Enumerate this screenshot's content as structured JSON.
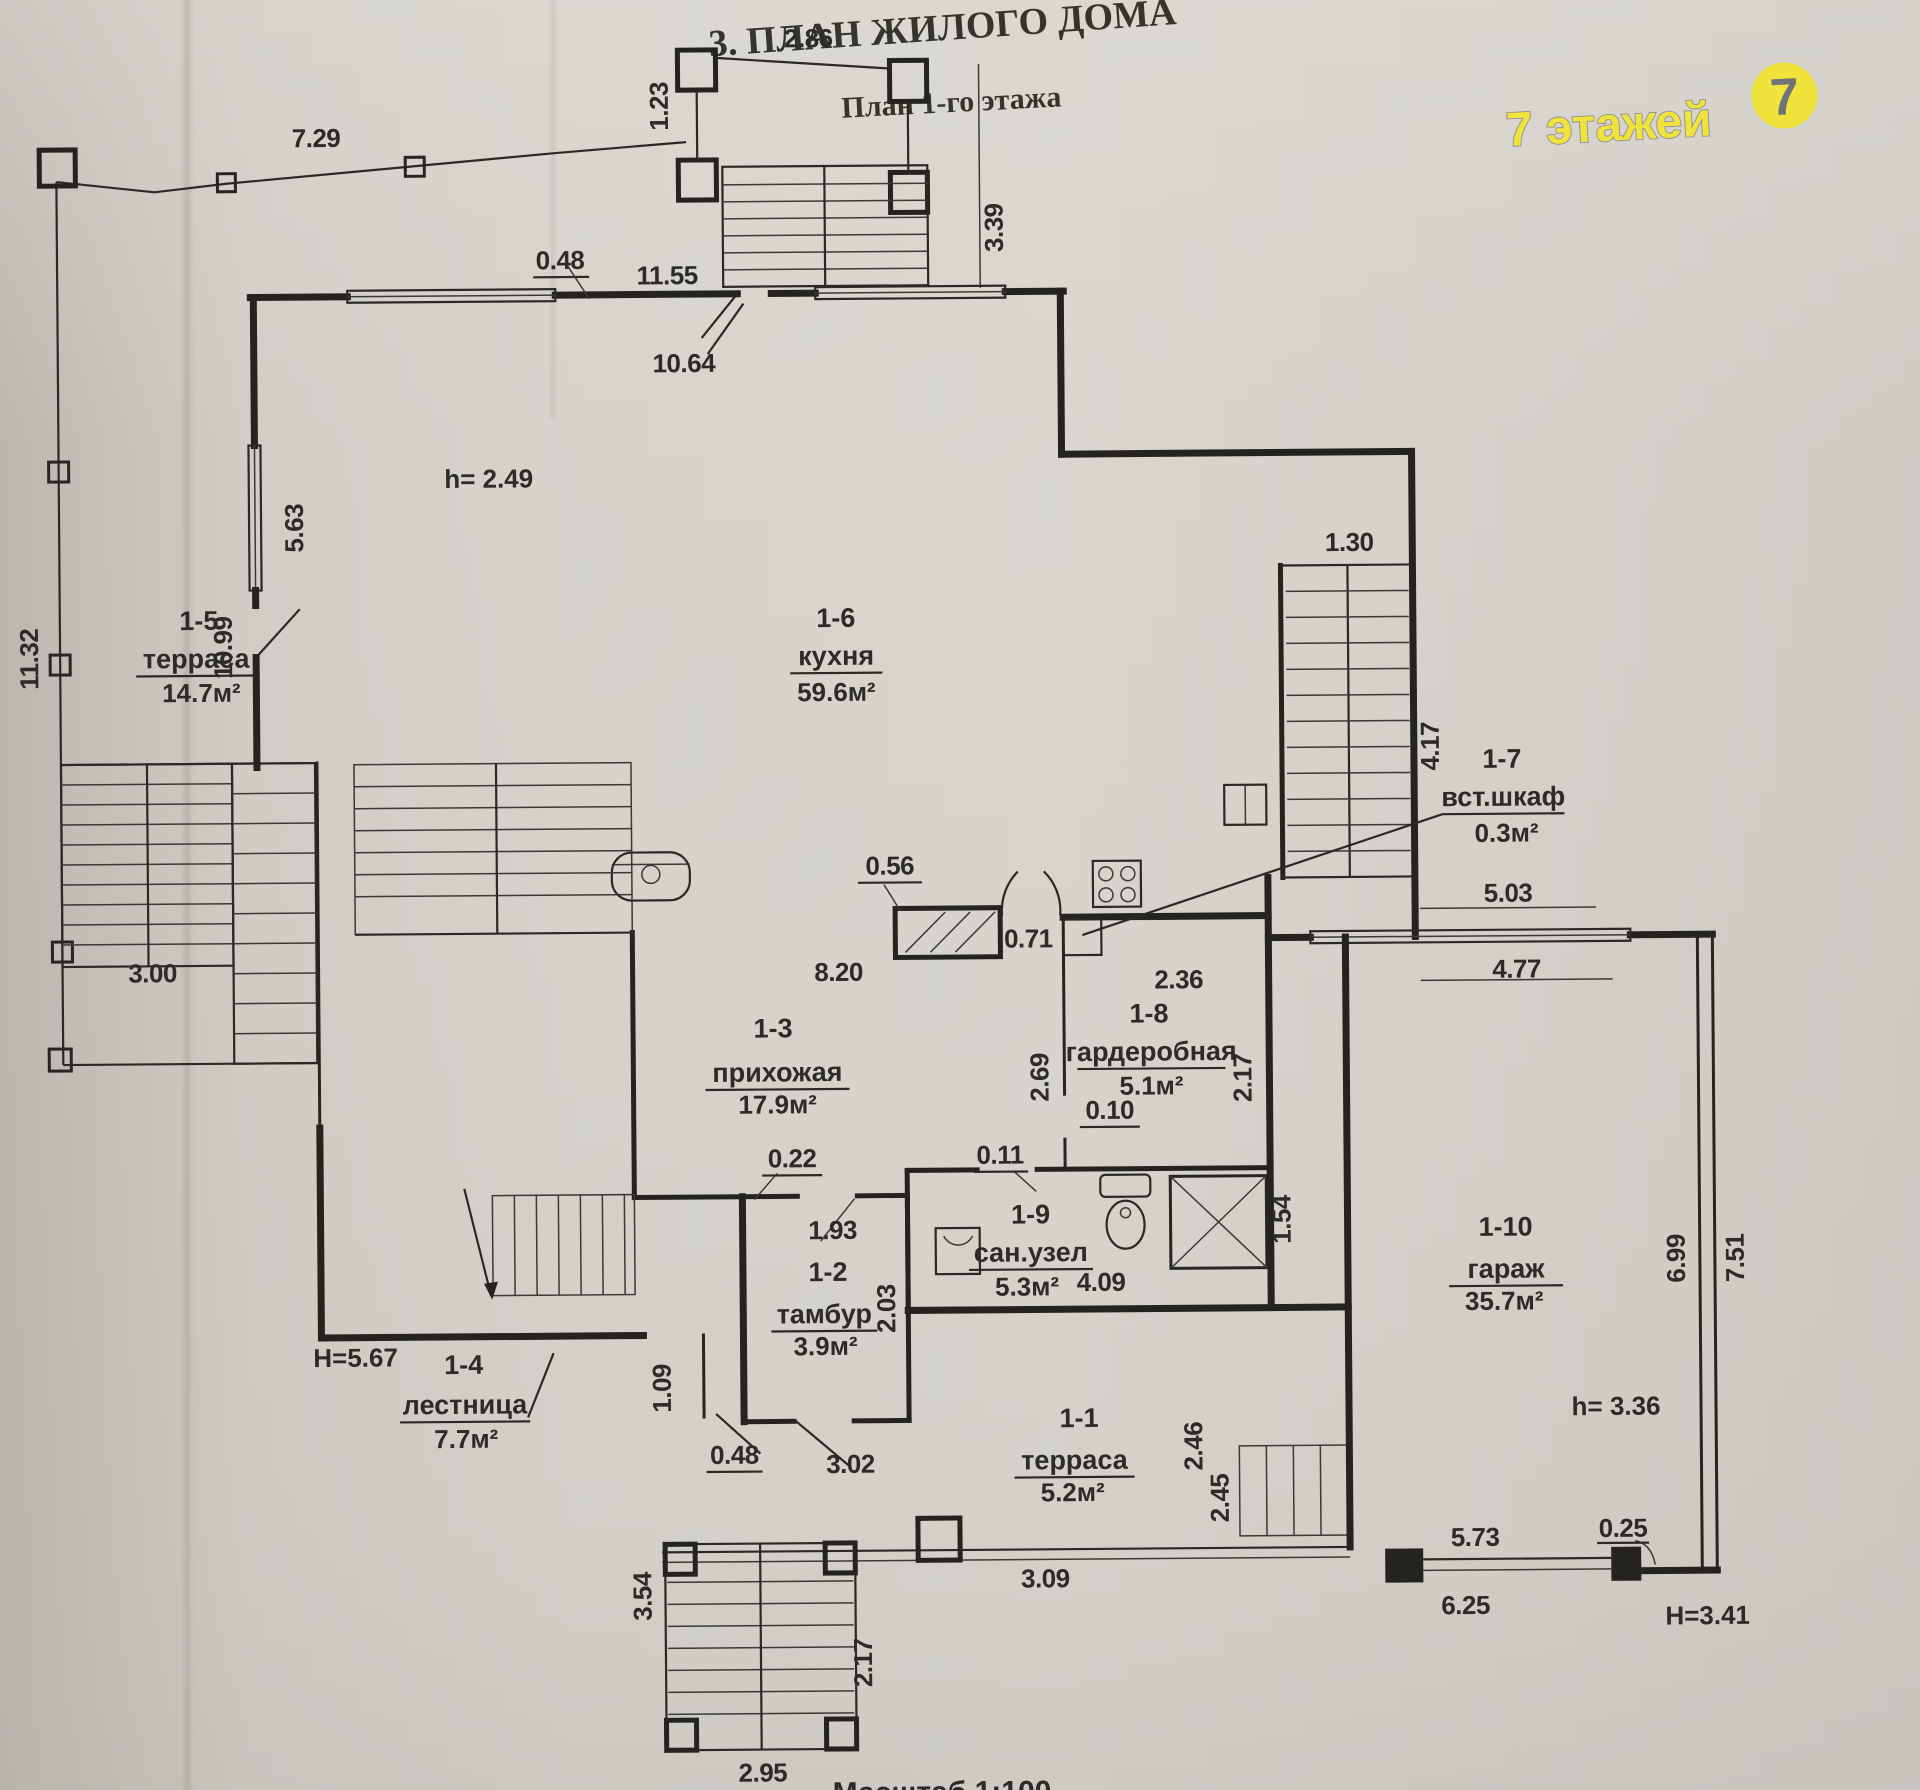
{
  "meta": {
    "title": "3. ПЛАН ЖИЛОГО ДОМА",
    "subtitle": "План 1-го этажа",
    "scale_note": "Масштаб 1:100"
  },
  "watermark": {
    "text": "7 этажей",
    "badge": "7",
    "brand_yellow": "#f0e43c",
    "brand_gray": "#8f9092"
  },
  "rooms": [
    {
      "id": "1-1",
      "name": "терраса",
      "area": "5.2м²"
    },
    {
      "id": "1-2",
      "name": "тамбур",
      "area": "3.9м²"
    },
    {
      "id": "1-3",
      "name": "прихожая",
      "area": "17.9м²"
    },
    {
      "id": "1-4",
      "name": "лестница",
      "area": "7.7м²"
    },
    {
      "id": "1-5",
      "name": "терраса",
      "area": "14.7м²"
    },
    {
      "id": "1-6",
      "name": "кухня",
      "area": "59.6м²"
    },
    {
      "id": "1-7",
      "name": "вст.шкаф",
      "area": "0.3м²"
    },
    {
      "id": "1-8",
      "name": "гардеробная",
      "area": "5.1м²"
    },
    {
      "id": "1-9",
      "name": "сан.узел",
      "area": "5.3м²"
    },
    {
      "id": "1-10",
      "name": "гараж",
      "area": "35.7м²"
    }
  ],
  "dims": {
    "top_terrace_width": "2.86",
    "top_terrace_side": "1.23",
    "top_terrace_depth": "3.39",
    "left_fence_top": "7.29",
    "top_wall_offset": "0.48",
    "top_wall_length": "11.55",
    "kitchen_top_inner": "10.64",
    "left_fence_height": "11.32",
    "left_wall_window": "5.63",
    "left_wall_lower": "10.99",
    "kitchen_height": "h= 2.49",
    "right_stairs_width": "1.30",
    "right_stairs_length": "4.17",
    "kitchen_pier_offset": "0.56",
    "kitchen_door": "0.71",
    "hall_opening": "8.20",
    "wardrobe_width": "2.36",
    "wardrobe_left": "2.69",
    "wardrobe_right": "2.17",
    "wardrobe_door": "0.10",
    "garage_window_out": "5.03",
    "garage_window_in": "4.77",
    "tambour_tick": "0.22",
    "tambour_width": "1.93",
    "tambour_depth": "2.03",
    "bath_door": "0.11",
    "bath_width": "4.09",
    "shower_size": "1.54",
    "left_steps_width": "3.00",
    "stair_total_height": "H=5.67",
    "tambour_gap": "1.09",
    "tambour_door": "0.48",
    "tambour_front": "3.02",
    "terrace1_side": "2.46",
    "terrace1_side2": "2.45",
    "terrace1_width": "3.09",
    "garage_depth_in": "6.99",
    "garage_depth_out": "7.51",
    "garage_height": "h= 3.36",
    "garage_gate_width": "5.73",
    "garage_gate_tick": "0.25",
    "garage_front": "6.25",
    "garage_gate_height": "H=3.41",
    "bottom_steps_side": "3.54",
    "bottom_steps_right": "2.17",
    "bottom_steps_width": "2.95"
  }
}
